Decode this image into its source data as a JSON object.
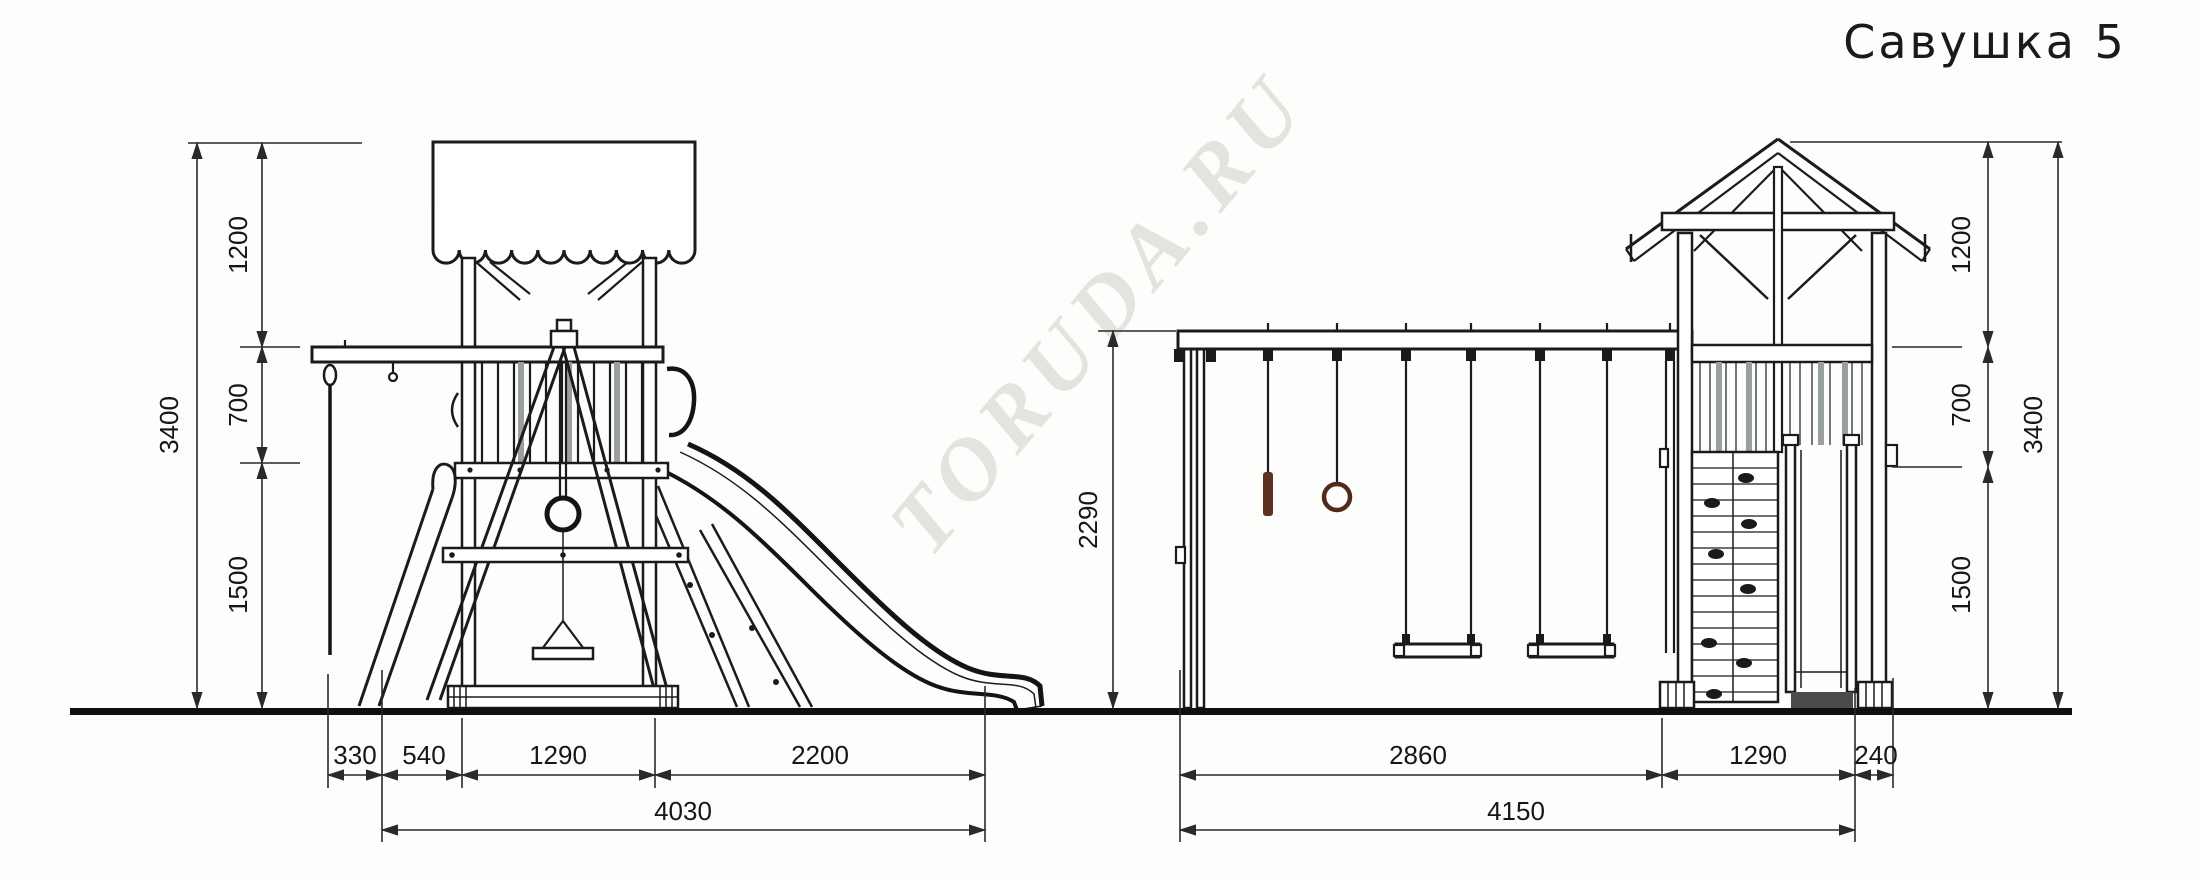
{
  "title": "Савушка 5",
  "watermark": "TORUDA.RU",
  "colors": {
    "line": "#1b1b1b",
    "dimension_line": "#2a2a2a",
    "wood_accent": "#5c3222",
    "ring_accent": "#4f2b1c",
    "slat_gray": "#9aa0a0",
    "ground": "#101010",
    "watermark_gray": "#e3e3df",
    "background": "#fdfdfc"
  },
  "left_view": {
    "vertical": {
      "total": "3400",
      "top": "1200",
      "middle": "700",
      "bottom": "1500"
    },
    "horizontal": {
      "rope_offset": "330",
      "ladder_span": "540",
      "tower_width": "1290",
      "slide_run": "2200",
      "overall": "4030"
    }
  },
  "right_view": {
    "beam_height": "2290",
    "vertical": {
      "top": "1200",
      "middle": "700",
      "bottom": "1500",
      "total": "3400"
    },
    "horizontal": {
      "swing_section": "2860",
      "tower_width": "1290",
      "rear_offset": "240",
      "overall": "4150"
    }
  }
}
